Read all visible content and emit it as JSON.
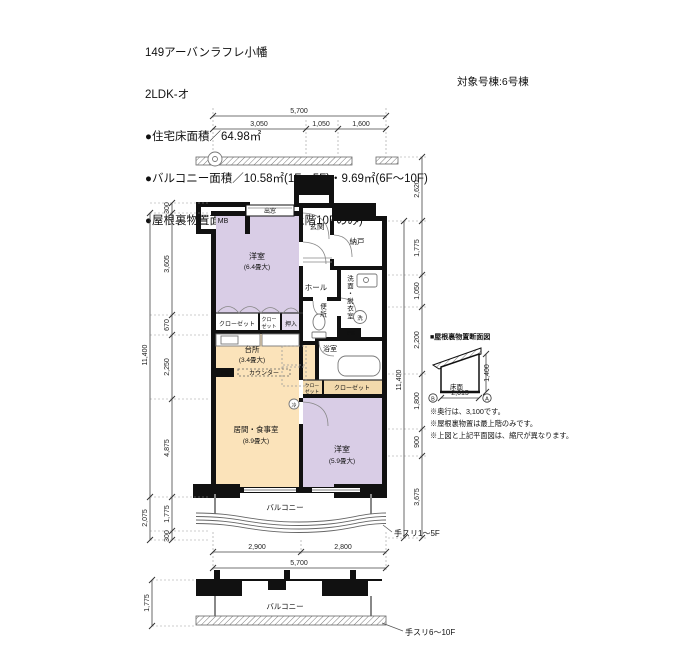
{
  "header": {
    "title": "149アーバンラフレ小幡",
    "plan_type": "2LDK-オ",
    "area_lines": [
      "●住宅床面積／64.98㎡",
      "●バルコニー面積／10.58㎡(1F〜5F)・9.69㎡(6F〜10F)",
      "●屋根裏物置面積／6.24㎡(最上階10Fのみ)"
    ],
    "target_building": "対象号棟:6号棟"
  },
  "dimensions": {
    "top": {
      "total": "5,700",
      "segments": [
        "3,050",
        "1,050",
        "1,600"
      ]
    },
    "left": {
      "segments": [
        "300",
        "3,605",
        "670",
        "2,250",
        "4,875",
        "1,775",
        "300"
      ],
      "overall": "11,400",
      "balcony_total": "2,075"
    },
    "right": {
      "above": "2,620",
      "segments": [
        "1,775",
        "1,050",
        "2,200",
        "1,800",
        "900",
        "3,675"
      ],
      "overall": "11,400"
    },
    "bottom": {
      "segments": [
        "2,900",
        "2,800"
      ],
      "total": "5,700"
    },
    "lower_balcony_depth": "1,775"
  },
  "rooms": {
    "mb": "MB",
    "bay_window": "出窓",
    "bedroom1": "洋室",
    "bedroom1_size": "(6.4畳大)",
    "entrance": "玄関",
    "storeroom": "納戸",
    "hall": "ホール",
    "toilet": "便所",
    "washroom": "洗面・脱衣室",
    "bath": "浴室",
    "closet1": "クローゼット",
    "closet2_line1": "クロー",
    "closet2_line2": "ゼット",
    "oshiire": "押入",
    "kitchen": "台所",
    "kitchen_size": "(3.4畳大)",
    "counter": "カウンター",
    "ps": "PS",
    "living": "居間・食事室",
    "living_size": "(8.9畳大)",
    "bedroom2": "洋室",
    "bedroom2_size": "(5.9畳大)",
    "closet3_line1": "クロー",
    "closet3_line2": "ゼット",
    "closet3_wide": "クローゼット",
    "washer_symbol": "洗",
    "fridge_symbol": "冷"
  },
  "balcony": {
    "label": "バルコニー",
    "rail_1_5f": "手スリ1〜5F",
    "rail_6_10f": "手スリ6〜10F"
  },
  "attic_section": {
    "title": "■屋根裏物置断面図",
    "floor_label": "床面",
    "width": "2,015",
    "height": "1,400",
    "mark_left": "B",
    "mark_right": "A",
    "notes": [
      "※奥行は、3,100です。",
      "※屋根裏物置は最上階のみです。",
      "※上図と上記平面図は、縮尺が異なります。"
    ]
  },
  "colors": {
    "bedroom_fill": "#d9cde6",
    "living_fill": "#fbe3ba",
    "oshiire_fill": "#e6ddf0",
    "closet_strip_fill": "#f2d9ac",
    "wall": "#111111"
  }
}
